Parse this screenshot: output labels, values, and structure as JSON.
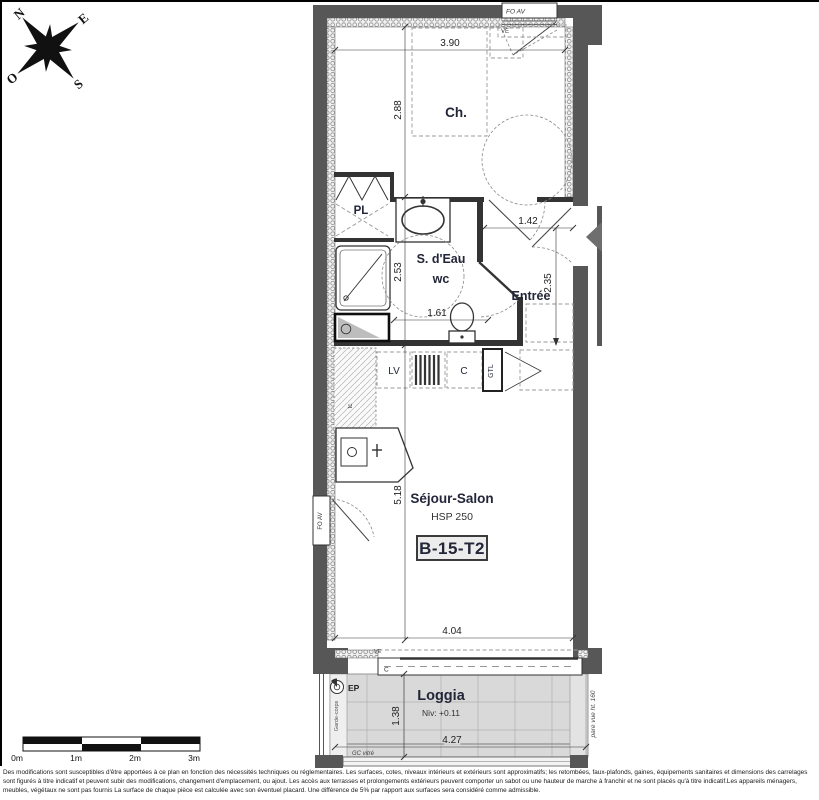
{
  "compass": {
    "n": "N",
    "e": "E",
    "s": "S",
    "o": "O"
  },
  "unit": {
    "code": "B-15-T2"
  },
  "rooms": {
    "bedroom": "Ch.",
    "closet": "PL",
    "shower": "S. d'Eau",
    "wc": "wc",
    "entry": "Entrée",
    "living": "Séjour-Salon",
    "living_hsp": "HSP 250",
    "loggia": "Loggia",
    "loggia_level": "Niv: +0.11"
  },
  "dims": {
    "top": "3.90",
    "bedroom": "2.88",
    "entry_w": "1.42",
    "entry_h": "2.35",
    "shower_h": "2.53",
    "wc_w": "1.61",
    "living_h": "5.18",
    "living_w": "4.04",
    "loggia_h": "1.38",
    "loggia_w": "4.27"
  },
  "ann": {
    "fo_av_top": "FO AV",
    "fo_av_left": "FO AV",
    "ve_top": "VE",
    "ve_bottom": "VE",
    "lv": "LV",
    "cooker": "C",
    "gtl": "GTL",
    "tc": "tc",
    "bay": "C",
    "ep": "EP",
    "gc_vitre": "GC vitré",
    "pare_vue": "pare vue ht. 160",
    "garde_corps": "Garde-corps"
  },
  "scalebar": {
    "m0": "0m",
    "m1": "1m",
    "m2": "2m",
    "m3": "3m"
  },
  "disclaimer": "Des modifications sont susceptibles d'être apportées à ce plan en fonction des nécessités techniques ou réglementaires. Les surfaces, cotes, niveaux intérieurs et extérieurs sont approximatifs; les retombées, faux-plafonds, gaines, équipements sanitaires et dimensions des carrelages sont figurés à titre indicatif et peuvent subir des modifications, changement d'emplacement, ou ajout. Les accès aux terrasses et prolongements extérieurs peuvent comporter un sabot ou une hauteur de marche à franchir et ne sont placés qu'à titre indicatif.Les appareils ménagers, meubles, végétaux ne sont pas fournis La surface de chaque pièce est calculée avec son éventuel placard. Une différence de 5% par rapport aux surfaces sera considéré comme admissible."
}
